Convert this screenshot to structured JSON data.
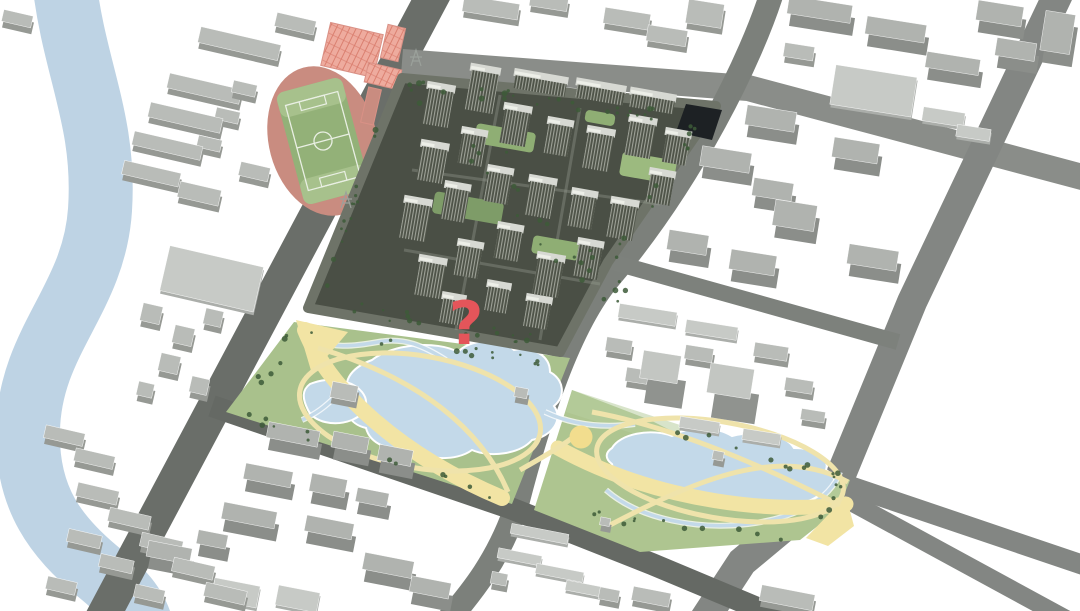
{
  "scene": {
    "width": 1080,
    "height": 611,
    "background": "#ffffff",
    "label": "3D aerial masterplan rendering of an urban district with river, stadium, residential development, lake parks and a red question-mark marker"
  },
  "marker": {
    "symbol": "?",
    "x": 466,
    "y": 344,
    "font_size": 60,
    "color": "#e4555a"
  },
  "colors": {
    "water": "#c3d9e9",
    "shore": "#ffffff",
    "path": "#f2e4a4",
    "loop": "#efe3ab",
    "band_light": "#b8cd9f"
  },
  "river": {
    "path": "M64,-20 C74,70 106,120 100,210 C94,300 30,340 28,430 C26,500 58,538 96,570 C118,588 132,600 140,622",
    "width": 64,
    "color": "#bed3e4"
  },
  "roads": [
    {
      "name": "road-main-west",
      "path": "M438,-14 L100,622",
      "width": 34,
      "color": "#6a6e69"
    },
    {
      "name": "road-north",
      "path": "M402,62 L748,88 L1086,178",
      "width": 26,
      "color": "#8a8d89"
    },
    {
      "name": "road-east-vertical",
      "path": "M774,-14 C752,60 690,182 610,277 C580,312 548,382 516,508 C498,560 472,592 448,620",
      "width": 24,
      "color": "#7c807b"
    },
    {
      "name": "road-far-east-diagonal",
      "path": "M1062,-14 L912,302 L838,482 L742,562 L704,620",
      "width": 30,
      "color": "#838683"
    },
    {
      "name": "road-fork-east",
      "path": "M838,482 L1086,566",
      "width": 20,
      "color": "#838683"
    },
    {
      "name": "road-fork-corner",
      "path": "M840,496 L1068,620",
      "width": 18,
      "color": "#838683"
    },
    {
      "name": "road-park-south",
      "path": "M212,406 L510,508 L652,564 L786,620",
      "width": 22,
      "color": "#656964"
    },
    {
      "name": "road-site-southeast",
      "path": "M612,262 L898,342",
      "width": 16,
      "color": "#7d817c"
    }
  ],
  "parks": [
    {
      "name": "west-park",
      "polygon": "294,322 570,358 512,504 226,412",
      "green": "#a9c18c",
      "ponds": [
        "M372,360 C392,344 436,340 458,352 C468,340 500,336 514,350 C534,346 550,356 550,372 C564,380 566,396 554,406 C564,420 552,436 532,440 C520,454 490,458 472,450 C456,462 424,460 410,448 C390,452 370,444 366,428 C348,424 342,408 352,396 C340,384 350,368 372,360 Z",
        "M310,384 C330,376 352,380 362,392 C370,402 366,414 352,420 C334,427 314,422 308,410 C302,398 302,390 310,384 Z"
      ],
      "creeks": [
        "M305,336 C330,350 356,346 378,342 C404,337 424,346 446,360",
        "M302,420 C316,414 326,406 336,396"
      ],
      "bands": [
        {
          "type": "stroke",
          "path": "M305,330 C330,392 402,456 502,498",
          "width": 16
        },
        {
          "type": "fill",
          "path": "M296,320 L348,332 L312,374 Z"
        }
      ],
      "loops": [
        {
          "cx": 420,
          "cy": 412,
          "rx": 122,
          "ry": 56,
          "rot": 10
        },
        {
          "path": "M318,348 C420,378 482,430 508,492"
        }
      ],
      "pavilions": [
        [
          345,
          398,
          26,
          16
        ],
        [
          522,
          399,
          13,
          10
        ]
      ]
    },
    {
      "name": "east-park",
      "polygon": "572,390 650,420 700,445 790,470 850,480 838,510 800,540 640,552 534,510",
      "green": "#aec590",
      "band_light": "572,390 850,480 842,500 566,412",
      "ponds": [
        "M612,448 C620,434 650,428 672,436 C688,426 716,426 732,436 C754,430 786,434 794,448 C816,448 830,458 826,470 C840,478 836,492 818,496 C804,506 776,508 760,500 C742,508 712,506 698,497 C678,501 656,496 648,485 C630,484 614,476 612,464 C604,458 606,452 612,448 Z"
      ],
      "creeks": [
        "M545,412 C575,426 605,428 635,424",
        "M606,490 C640,520 700,530 748,524 C796,518 830,500 840,472"
      ],
      "bands": [
        {
          "type": "stroke",
          "path": "M558,448 C660,504 780,514 846,504",
          "width": 15
        },
        {
          "type": "fill",
          "path": "M806,538 L846,496 L854,526 L828,546 Z"
        }
      ],
      "loops": [
        {
          "cx": 720,
          "cy": 470,
          "rx": 125,
          "ry": 48,
          "rot": 10
        },
        {
          "path": "M592,412 C690,430 790,480 840,505"
        },
        {
          "path": "M610,525 C700,478 780,445 848,482"
        },
        {
          "path": "M520,470 C545,456 562,446 572,438"
        }
      ],
      "plaza": {
        "cx": 581,
        "cy": 437,
        "r": 11.5,
        "color": "#f2dd8e"
      },
      "pavilions": [
        [
          719,
          462,
          11,
          9
        ],
        [
          606,
          528,
          10,
          8
        ]
      ]
    }
  ],
  "stadium": {
    "cx": 323,
    "cy": 141,
    "rot": -15,
    "track_color": "#c98c80",
    "track_rx": 54,
    "track_ry": 76,
    "field_color": "#93b178",
    "field_end_color": "#a7c18c",
    "line_color": "#e9efe3"
  },
  "courts": {
    "fill": "#eeab9e",
    "line": "#d97b6c",
    "items": [
      [
        352,
        50,
        54,
        44,
        13,
        "grid"
      ],
      [
        393,
        43,
        18,
        34,
        13,
        "grid"
      ],
      [
        383,
        76,
        34,
        20,
        13,
        "grid"
      ],
      [
        371,
        106,
        13,
        36,
        13,
        "solid"
      ]
    ]
  },
  "site": {
    "outline": "402,78 716,106 608,262 560,352 308,308",
    "base": "#4a4f45",
    "edge": "#6e7368",
    "dark_building": "686,104 722,110 712,140 676,132",
    "dark_color": "#1d2124",
    "roof": "#d7d9d3",
    "facade_dark": "#4e5348",
    "facade_light": "#c9cdc3",
    "courtyards": [
      [
        505,
        138,
        60,
        20
      ],
      [
        648,
        168,
        55,
        24
      ],
      [
        468,
        208,
        70,
        22
      ],
      [
        556,
        248,
        48,
        18
      ],
      [
        600,
        118,
        30,
        12
      ]
    ],
    "court_colors": [
      "#8fae74",
      "#9cba7f",
      "#7e9c68",
      "#8fae74",
      "#8fae74"
    ],
    "lanes": [
      "M412,170 L660,204",
      "M404,250 L600,284",
      "M500,95 L456,330",
      "M580,108 L540,340"
    ],
    "towers": [
      [
        438,
        108,
        26,
        36
      ],
      [
        482,
        92,
        28,
        40
      ],
      [
        540,
        86,
        52,
        13
      ],
      [
        600,
        95,
        48,
        13
      ],
      [
        652,
        104,
        44,
        13
      ],
      [
        432,
        165,
        26,
        34
      ],
      [
        472,
        150,
        24,
        30
      ],
      [
        515,
        128,
        26,
        34
      ],
      [
        558,
        140,
        24,
        30
      ],
      [
        598,
        152,
        26,
        36
      ],
      [
        640,
        140,
        26,
        34
      ],
      [
        676,
        150,
        24,
        28
      ],
      [
        415,
        222,
        26,
        36
      ],
      [
        455,
        205,
        24,
        32
      ],
      [
        498,
        188,
        24,
        30
      ],
      [
        540,
        200,
        26,
        34
      ],
      [
        582,
        212,
        24,
        32
      ],
      [
        622,
        222,
        26,
        34
      ],
      [
        660,
        190,
        24,
        28
      ],
      [
        430,
        280,
        26,
        34
      ],
      [
        468,
        262,
        24,
        30
      ],
      [
        508,
        245,
        24,
        30
      ],
      [
        548,
        278,
        26,
        36
      ],
      [
        588,
        262,
        24,
        32
      ],
      [
        452,
        312,
        22,
        24
      ],
      [
        497,
        300,
        22,
        24
      ],
      [
        537,
        315,
        24,
        26
      ]
    ]
  },
  "blocks": {
    "kinds": {
      "s": {
        "top": "#b9bcb8",
        "side": "#969994",
        "lift": 6
      },
      "t": {
        "top": "#b0b3af",
        "side": "#8b8e8a",
        "lift": 12
      },
      "f": {
        "top": "#c7cac6",
        "side": "#abaeaa",
        "lift": 3
      },
      "T": {
        "top": "#c3c6c2",
        "side": "#90938f",
        "lift": 24
      }
    },
    "items": [
      [
        240,
        50,
        82,
        16,
        13,
        "s"
      ],
      [
        296,
        30,
        40,
        14,
        13,
        "s"
      ],
      [
        205,
        95,
        74,
        15,
        13,
        "s"
      ],
      [
        186,
        124,
        74,
        15,
        13,
        "s"
      ],
      [
        168,
        152,
        70,
        14,
        13,
        "s"
      ],
      [
        152,
        180,
        58,
        14,
        13,
        "s"
      ],
      [
        245,
        95,
        24,
        12,
        13,
        "s"
      ],
      [
        228,
        122,
        24,
        12,
        13,
        "s"
      ],
      [
        210,
        150,
        24,
        12,
        13,
        "s"
      ],
      [
        200,
        200,
        42,
        16,
        13,
        "s"
      ],
      [
        255,
        178,
        30,
        14,
        13,
        "s"
      ],
      [
        18,
        25,
        30,
        12,
        13,
        "s"
      ],
      [
        212,
        282,
        96,
        46,
        13,
        "f"
      ],
      [
        152,
        320,
        20,
        18,
        13,
        "s"
      ],
      [
        184,
        342,
        20,
        18,
        13,
        "s"
      ],
      [
        214,
        324,
        18,
        16,
        13,
        "s"
      ],
      [
        170,
        370,
        20,
        18,
        13,
        "s"
      ],
      [
        200,
        392,
        18,
        16,
        13,
        "s"
      ],
      [
        146,
        396,
        16,
        14,
        13,
        "s"
      ],
      [
        65,
        442,
        40,
        13,
        13,
        "s"
      ],
      [
        95,
        465,
        40,
        13,
        13,
        "s"
      ],
      [
        98,
        500,
        42,
        14,
        13,
        "s"
      ],
      [
        130,
        525,
        42,
        14,
        13,
        "s"
      ],
      [
        162,
        550,
        42,
        14,
        13,
        "s"
      ],
      [
        194,
        575,
        42,
        14,
        13,
        "s"
      ],
      [
        226,
        600,
        42,
        14,
        13,
        "s"
      ],
      [
        85,
        545,
        34,
        13,
        13,
        "s"
      ],
      [
        117,
        570,
        34,
        13,
        13,
        "s"
      ],
      [
        62,
        592,
        30,
        13,
        13,
        "s"
      ],
      [
        150,
        600,
        30,
        13,
        13,
        "s"
      ],
      [
        492,
        14,
        56,
        16,
        9,
        "s"
      ],
      [
        550,
        8,
        38,
        14,
        9,
        "s"
      ],
      [
        628,
        25,
        46,
        16,
        9,
        "s"
      ],
      [
        668,
        42,
        40,
        16,
        9,
        "s"
      ],
      [
        706,
        20,
        36,
        24,
        9,
        "s"
      ],
      [
        822,
        22,
        64,
        18,
        9,
        "t"
      ],
      [
        898,
        42,
        60,
        18,
        9,
        "t"
      ],
      [
        800,
        58,
        30,
        14,
        9,
        "s"
      ],
      [
        874,
        94,
        82,
        40,
        9,
        "f"
      ],
      [
        944,
        120,
        42,
        14,
        9,
        "f"
      ],
      [
        974,
        136,
        34,
        12,
        9,
        "f"
      ],
      [
        955,
        76,
        54,
        16,
        9,
        "t"
      ],
      [
        1002,
        26,
        46,
        20,
        9,
        "t"
      ],
      [
        1018,
        62,
        40,
        18,
        9,
        "t"
      ],
      [
        1060,
        45,
        30,
        40,
        9,
        "t"
      ],
      [
        773,
        131,
        50,
        20,
        9,
        "t"
      ],
      [
        728,
        172,
        50,
        20,
        9,
        "t"
      ],
      [
        858,
        163,
        46,
        20,
        9,
        "t"
      ],
      [
        775,
        202,
        40,
        18,
        9,
        "t"
      ],
      [
        797,
        228,
        42,
        26,
        9,
        "t"
      ],
      [
        690,
        255,
        40,
        20,
        9,
        "t"
      ],
      [
        755,
        275,
        46,
        20,
        9,
        "t"
      ],
      [
        875,
        270,
        50,
        20,
        9,
        "t"
      ],
      [
        648,
        318,
        58,
        14,
        9,
        "f"
      ],
      [
        712,
        333,
        52,
        13,
        9,
        "f"
      ],
      [
        620,
        352,
        26,
        14,
        9,
        "s"
      ],
      [
        638,
        382,
        22,
        14,
        9,
        "s"
      ],
      [
        665,
        392,
        38,
        28,
        9,
        "T"
      ],
      [
        735,
        406,
        44,
        30,
        9,
        "T"
      ],
      [
        700,
        360,
        28,
        14,
        9,
        "s"
      ],
      [
        772,
        358,
        34,
        14,
        9,
        "s"
      ],
      [
        700,
        428,
        40,
        11,
        9,
        "f"
      ],
      [
        762,
        440,
        38,
        11,
        9,
        "f"
      ],
      [
        800,
        392,
        28,
        13,
        9,
        "s"
      ],
      [
        814,
        422,
        24,
        11,
        9,
        "s"
      ],
      [
        295,
        447,
        52,
        16,
        11,
        "t"
      ],
      [
        352,
        455,
        36,
        16,
        11,
        "t"
      ],
      [
        397,
        468,
        34,
        16,
        11,
        "t"
      ],
      [
        270,
        488,
        48,
        16,
        11,
        "t"
      ],
      [
        330,
        498,
        36,
        18,
        11,
        "t"
      ],
      [
        374,
        510,
        32,
        14,
        11,
        "t"
      ],
      [
        251,
        528,
        54,
        17,
        11,
        "t"
      ],
      [
        331,
        540,
        48,
        16,
        11,
        "t"
      ],
      [
        390,
        578,
        50,
        17,
        11,
        "t"
      ],
      [
        171,
        565,
        44,
        16,
        11,
        "t"
      ],
      [
        214,
        552,
        30,
        14,
        11,
        "t"
      ],
      [
        432,
        600,
        40,
        16,
        11,
        "t"
      ],
      [
        236,
        596,
        46,
        22,
        11,
        "f"
      ],
      [
        298,
        602,
        42,
        20,
        11,
        "f"
      ],
      [
        540,
        537,
        58,
        10,
        11,
        "f"
      ],
      [
        520,
        560,
        44,
        10,
        11,
        "f"
      ],
      [
        560,
        576,
        48,
        10,
        11,
        "f"
      ],
      [
        586,
        592,
        40,
        10,
        11,
        "f"
      ],
      [
        500,
        585,
        16,
        12,
        11,
        "s"
      ],
      [
        610,
        601,
        20,
        12,
        11,
        "s"
      ],
      [
        788,
        604,
        54,
        16,
        11,
        "s"
      ],
      [
        652,
        603,
        38,
        14,
        11,
        "s"
      ]
    ]
  },
  "pylons": [
    [
      416,
      58
    ],
    [
      346,
      200
    ]
  ],
  "trees": {
    "color": "#3d5a38",
    "clusters": [
      [
        408,
        84,
        700,
        120,
        26,
        6
      ],
      [
        398,
        86,
        318,
        295,
        14,
        6
      ],
      [
        315,
        302,
        552,
        344,
        18,
        7
      ],
      [
        700,
        122,
        614,
        258,
        12,
        6
      ],
      [
        305,
        330,
        558,
        362,
        13,
        5
      ],
      [
        235,
        412,
        505,
        500,
        12,
        5
      ],
      [
        242,
        404,
        296,
        332,
        6,
        5
      ],
      [
        600,
        408,
        840,
        478,
        12,
        5
      ],
      [
        548,
        512,
        798,
        538,
        11,
        5
      ],
      [
        430,
        120,
        640,
        300,
        24,
        28
      ],
      [
        838,
        486,
        820,
        520,
        5,
        5
      ]
    ]
  }
}
